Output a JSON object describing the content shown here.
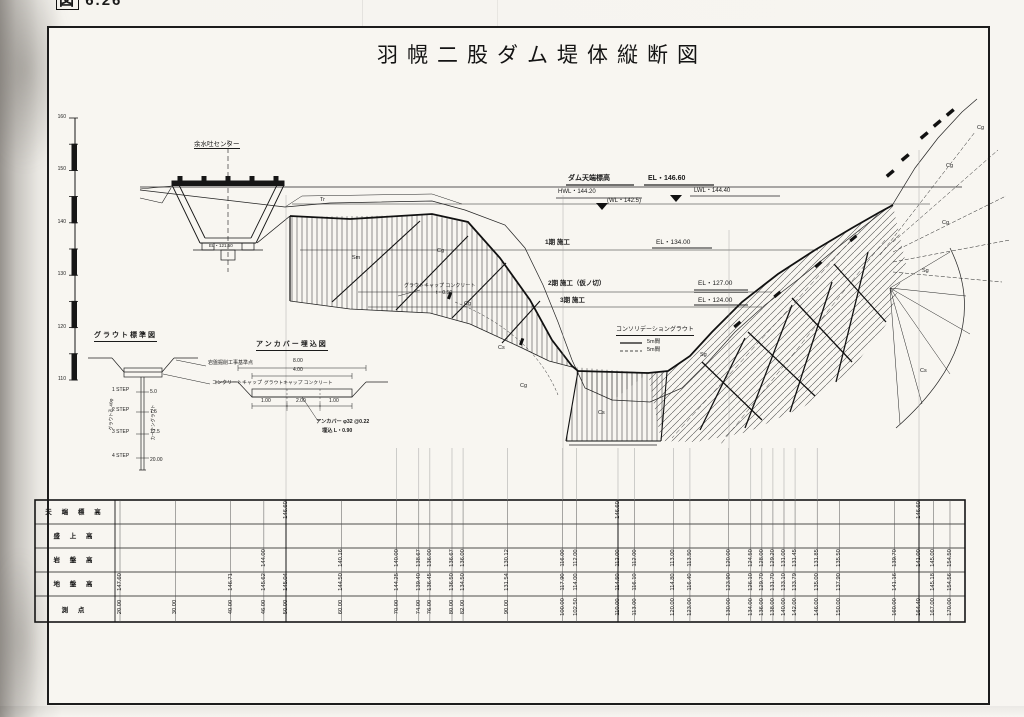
{
  "figure": {
    "prefix": "図",
    "number": "6.26"
  },
  "title": "羽幌二股ダム堤体縦断図",
  "elevation_scale": {
    "ticks": [
      "160",
      "150",
      "140",
      "130",
      "120",
      "110"
    ]
  },
  "water_labels": {
    "crest_title": "ダム天端標高",
    "crest_el": "EL・146.60",
    "hwl": "HWL・144.20",
    "wl": "(WL・142.5)",
    "nwl": "LWL・144.40"
  },
  "spillway": {
    "center_label": "余水吐センター",
    "invert_el": "EL・121.50"
  },
  "stages": {
    "s1": "1期 施工",
    "s1_el": "EL・134.00",
    "s2": "2期 施工（仮ノ切）",
    "s2_el": "EL・127.00",
    "s3": "3期 施工",
    "s3_el": "EL・124.00",
    "grout_cap": "グラウトキャップ コンクリート",
    "grout_cap_t": "t・0.50"
  },
  "legend": {
    "title": "コンソリデーショングラウト",
    "solid_label": "5m間",
    "dashed_label": "5m間"
  },
  "geology_labels": [
    {
      "t": "Tr",
      "x": 320,
      "y": 197
    },
    {
      "t": "Sm",
      "x": 352,
      "y": 255
    },
    {
      "t": "Cg",
      "x": 437,
      "y": 248
    },
    {
      "t": "Cg",
      "x": 464,
      "y": 301
    },
    {
      "t": "Cs",
      "x": 498,
      "y": 345
    },
    {
      "t": "Cg",
      "x": 520,
      "y": 383
    },
    {
      "t": "Cs",
      "x": 598,
      "y": 410
    },
    {
      "t": "Sg",
      "x": 700,
      "y": 352
    },
    {
      "t": "Sg",
      "x": 922,
      "y": 268
    },
    {
      "t": "Cg",
      "x": 942,
      "y": 220
    },
    {
      "t": "Cg",
      "x": 946,
      "y": 163
    },
    {
      "t": "Cg",
      "x": 977,
      "y": 125
    },
    {
      "t": "Cs",
      "x": 920,
      "y": 368
    }
  ],
  "detail_grout": {
    "title": "グラウト標準図",
    "rock_ref": "岩盤掘削工事基準点",
    "cap": "コンクリートキャップ",
    "hole": "グラウト孔 40φ",
    "curtain": "カーテングラウト",
    "steps": [
      "1 STEP",
      "2 STEP",
      "3 STEP",
      "4 STEP"
    ],
    "depths": [
      "5.0",
      "7.5",
      "12.5",
      "20.00"
    ]
  },
  "detail_anchor": {
    "title": "アンカバー埋込図",
    "cap": "グラウトキャップ コンクリート",
    "dim_top": "8.00",
    "dim_mid": "4.00",
    "dim_l": "1.00",
    "dim_c": "2.00",
    "dim_r": "1.00",
    "note1": "アンカバー φ32 @0.22",
    "note2": "埋込 L・0.90"
  },
  "table": {
    "row_labels": [
      "天 端 標 高",
      "盛 上 高",
      "岩 盤 高",
      "地 盤 高",
      "測  点"
    ],
    "columns": [
      {
        "station": "20.00",
        "crest": "",
        "fill": "",
        "rock": "",
        "ground": "147.60"
      },
      {
        "station": "30.00",
        "crest": "",
        "fill": "",
        "rock": "",
        "ground": ""
      },
      {
        "station": "40.00",
        "crest": "",
        "fill": "",
        "rock": "",
        "ground": "146.71"
      },
      {
        "station": "46.00",
        "crest": "",
        "fill": "",
        "rock": "144.00",
        "ground": "145.62"
      },
      {
        "station": "50.00",
        "crest": "146.60",
        "fill": "",
        "rock": "",
        "ground": "145.04"
      },
      {
        "station": "60.00",
        "crest": "",
        "fill": "",
        "rock": "140.16",
        "ground": "144.50"
      },
      {
        "station": "70.00",
        "crest": "",
        "fill": "",
        "rock": "140.00",
        "ground": "144.25"
      },
      {
        "station": "74.00",
        "crest": "",
        "fill": "",
        "rock": "138.67",
        "ground": "139.40"
      },
      {
        "station": "76.00",
        "crest": "",
        "fill": "",
        "rock": "136.00",
        "ground": "136.45"
      },
      {
        "station": "80.00",
        "crest": "",
        "fill": "",
        "rock": "136.67",
        "ground": "136.50"
      },
      {
        "station": "82.00",
        "crest": "",
        "fill": "",
        "rock": "136.00",
        "ground": "134.50"
      },
      {
        "station": "90.00",
        "crest": "",
        "fill": "",
        "rock": "130.12",
        "ground": "131.54"
      },
      {
        "station": "100.00",
        "crest": "",
        "fill": "",
        "rock": "116.00",
        "ground": "117.90"
      },
      {
        "station": "102.50",
        "crest": "",
        "fill": "",
        "rock": "112.00",
        "ground": "114.00"
      },
      {
        "station": "110.00",
        "crest": "146.60",
        "fill": "",
        "rock": "112.00",
        "ground": "114.50"
      },
      {
        "station": "113.00",
        "crest": "",
        "fill": "",
        "rock": "112.00",
        "ground": "116.10"
      },
      {
        "station": "120.00",
        "crest": "",
        "fill": "",
        "rock": "113.00",
        "ground": "114.80"
      },
      {
        "station": "123.00",
        "crest": "",
        "fill": "",
        "rock": "113.50",
        "ground": "116.40"
      },
      {
        "station": "130.00",
        "crest": "",
        "fill": "",
        "rock": "120.00",
        "ground": "123.90"
      },
      {
        "station": "134.00",
        "crest": "",
        "fill": "",
        "rock": "124.50",
        "ground": "126.10"
      },
      {
        "station": "136.00",
        "crest": "",
        "fill": "",
        "rock": "128.00",
        "ground": "129.70"
      },
      {
        "station": "138.00",
        "crest": "",
        "fill": "",
        "rock": "129.20",
        "ground": "131.70"
      },
      {
        "station": "140.00",
        "crest": "",
        "fill": "",
        "rock": "131.00",
        "ground": "133.10"
      },
      {
        "station": "142.00",
        "crest": "",
        "fill": "",
        "rock": "131.45",
        "ground": "133.79"
      },
      {
        "station": "146.00",
        "crest": "",
        "fill": "",
        "rock": "131.85",
        "ground": "135.00"
      },
      {
        "station": "150.00",
        "crest": "",
        "fill": "",
        "rock": "135.50",
        "ground": "137.90"
      },
      {
        "station": "160.00",
        "crest": "",
        "fill": "",
        "rock": "139.70",
        "ground": "141.16"
      },
      {
        "station": "164.40",
        "crest": "146.60",
        "fill": "",
        "rock": "141.00",
        "ground": ""
      },
      {
        "station": "167.00",
        "crest": "",
        "fill": "",
        "rock": "145.00",
        "ground": "145.18"
      },
      {
        "station": "170.00",
        "crest": "",
        "fill": "",
        "rock": "154.50",
        "ground": "154.56"
      }
    ]
  }
}
